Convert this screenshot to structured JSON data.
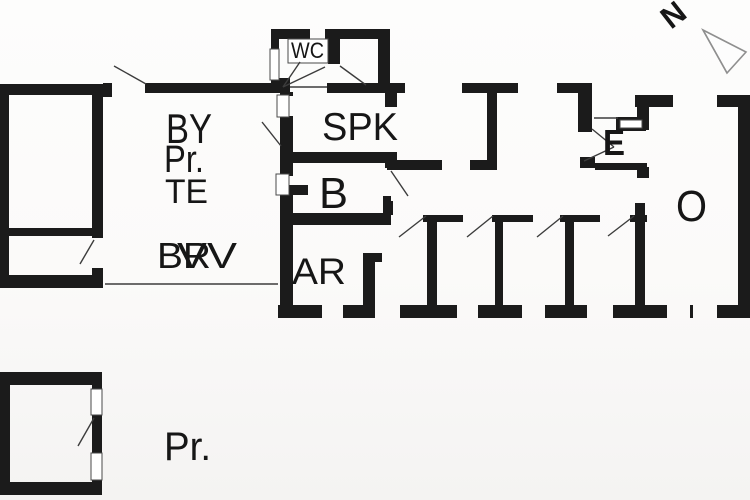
{
  "title": "Holiday house floor plan",
  "canvas": {
    "w": 750,
    "h": 500,
    "bg": "#fbfbfa"
  },
  "colors": {
    "wall": "#1b1b1b",
    "line": "#3c3c3c",
    "window_stroke": "#4a4a4a",
    "label": "#161616",
    "compass": "#8f8f8f"
  },
  "compass": {
    "n_label": "N",
    "translate_x": 671,
    "translate_y": 30,
    "rotate": -38,
    "font_size": 31,
    "body_points": "703,30 746,52 727,73",
    "fold_points": "703,30 717,55 727,73"
  },
  "labels": [
    {
      "name": "room-label-by",
      "text": "BY",
      "x": 166,
      "y": 143,
      "size": 42,
      "len": 46,
      "bold": false
    },
    {
      "name": "room-label-pr-upper",
      "text": "Pr.",
      "x": 164,
      "y": 172,
      "size": 38,
      "len": 40,
      "bold": false
    },
    {
      "name": "room-label-te",
      "text": "TE",
      "x": 165,
      "y": 203,
      "size": 34,
      "len": 43,
      "bold": false
    },
    {
      "name": "room-label-br",
      "text": "BR",
      "x": 157,
      "y": 268,
      "size": 36,
      "len": 54,
      "bold": false
    },
    {
      "name": "room-label-vv",
      "text": "VV",
      "x": 177,
      "y": 268,
      "size": 36,
      "len": 60,
      "bold": false
    },
    {
      "name": "room-label-ar",
      "text": "AR",
      "x": 292,
      "y": 284,
      "size": 37,
      "len": 54,
      "bold": false
    },
    {
      "name": "room-label-spk",
      "text": "SPK",
      "x": 322,
      "y": 140,
      "size": 39,
      "len": 76,
      "bold": false
    },
    {
      "name": "room-label-b",
      "text": "B",
      "x": 319,
      "y": 208,
      "size": 44,
      "len": 29,
      "bold": false
    },
    {
      "name": "room-label-wc",
      "text": "WC",
      "x": 291,
      "y": 58,
      "size": 22,
      "len": 33,
      "bold": false
    },
    {
      "name": "room-label-e",
      "text": "E",
      "x": 603,
      "y": 155,
      "size": 36,
      "len": 22,
      "bold": true
    },
    {
      "name": "room-label-o",
      "text": "O",
      "x": 676,
      "y": 221,
      "size": 44,
      "len": 31,
      "bold": false
    },
    {
      "name": "annex-label-pr",
      "text": "Pr.",
      "x": 164,
      "y": 460,
      "size": 40,
      "len": 47,
      "bold": false
    }
  ],
  "walls": [
    {
      "x": 0,
      "y": 84,
      "w": 103,
      "h": 11
    },
    {
      "x": 0,
      "y": 84,
      "w": 9,
      "h": 204
    },
    {
      "x": 0,
      "y": 275,
      "w": 103,
      "h": 13
    },
    {
      "x": 92,
      "y": 84,
      "w": 11,
      "h": 154
    },
    {
      "x": 92,
      "y": 268,
      "w": 11,
      "h": 20
    },
    {
      "x": 9,
      "y": 228,
      "w": 88,
      "h": 8
    },
    {
      "x": 103,
      "y": 83,
      "w": 9,
      "h": 14
    },
    {
      "x": 145,
      "y": 83,
      "w": 145,
      "h": 10
    },
    {
      "x": 327,
      "y": 83,
      "w": 78,
      "h": 10
    },
    {
      "x": 462,
      "y": 83,
      "w": 56,
      "h": 10
    },
    {
      "x": 557,
      "y": 83,
      "w": 33,
      "h": 10
    },
    {
      "x": 271,
      "y": 78,
      "w": 19,
      "h": 12
    },
    {
      "x": 578,
      "y": 83,
      "w": 14,
      "h": 49
    },
    {
      "x": 580,
      "y": 157,
      "w": 15,
      "h": 11
    },
    {
      "x": 595,
      "y": 163,
      "w": 52,
      "h": 7
    },
    {
      "x": 280,
      "y": 92,
      "w": 13,
      "h": 4
    },
    {
      "x": 280,
      "y": 116,
      "w": 13,
      "h": 60
    },
    {
      "x": 280,
      "y": 194,
      "w": 13,
      "h": 111
    },
    {
      "x": 273,
      "y": 29,
      "w": 37,
      "h": 10
    },
    {
      "x": 325,
      "y": 29,
      "w": 65,
      "h": 10
    },
    {
      "x": 271,
      "y": 29,
      "w": 8,
      "h": 20
    },
    {
      "x": 378,
      "y": 29,
      "w": 12,
      "h": 63
    },
    {
      "x": 328,
      "y": 38,
      "w": 12,
      "h": 26
    },
    {
      "x": 385,
      "y": 83,
      "w": 12,
      "h": 24
    },
    {
      "x": 283,
      "y": 152,
      "w": 104,
      "h": 11
    },
    {
      "x": 385,
      "y": 152,
      "w": 12,
      "h": 16
    },
    {
      "x": 283,
      "y": 213,
      "w": 108,
      "h": 12
    },
    {
      "x": 383,
      "y": 196,
      "w": 8,
      "h": 18
    },
    {
      "x": 383,
      "y": 201,
      "w": 10,
      "h": 14
    },
    {
      "x": 288,
      "y": 185,
      "w": 20,
      "h": 10
    },
    {
      "x": 387,
      "y": 160,
      "w": 55,
      "h": 10
    },
    {
      "x": 470,
      "y": 160,
      "w": 27,
      "h": 10
    },
    {
      "x": 487,
      "y": 92,
      "w": 10,
      "h": 68
    },
    {
      "x": 423,
      "y": 215,
      "w": 40,
      "h": 7
    },
    {
      "x": 492,
      "y": 215,
      "w": 41,
      "h": 7
    },
    {
      "x": 560,
      "y": 215,
      "w": 40,
      "h": 7
    },
    {
      "x": 630,
      "y": 215,
      "w": 17,
      "h": 7
    },
    {
      "x": 427,
      "y": 215,
      "w": 10,
      "h": 90
    },
    {
      "x": 495,
      "y": 215,
      "w": 8,
      "h": 90
    },
    {
      "x": 565,
      "y": 215,
      "w": 9,
      "h": 90
    },
    {
      "x": 363,
      "y": 253,
      "w": 12,
      "h": 52
    },
    {
      "x": 363,
      "y": 253,
      "w": 19,
      "h": 9
    },
    {
      "x": 278,
      "y": 305,
      "w": 44,
      "h": 13
    },
    {
      "x": 343,
      "y": 305,
      "w": 32,
      "h": 13
    },
    {
      "x": 400,
      "y": 305,
      "w": 57,
      "h": 13
    },
    {
      "x": 478,
      "y": 305,
      "w": 44,
      "h": 13
    },
    {
      "x": 545,
      "y": 305,
      "w": 42,
      "h": 13
    },
    {
      "x": 613,
      "y": 305,
      "w": 54,
      "h": 13
    },
    {
      "x": 690,
      "y": 305,
      "w": 3,
      "h": 13
    },
    {
      "x": 717,
      "y": 305,
      "w": 33,
      "h": 13
    },
    {
      "x": 635,
      "y": 95,
      "w": 38,
      "h": 12
    },
    {
      "x": 717,
      "y": 95,
      "w": 33,
      "h": 12
    },
    {
      "x": 738,
      "y": 95,
      "w": 12,
      "h": 223
    },
    {
      "x": 637,
      "y": 95,
      "w": 12,
      "h": 35
    },
    {
      "x": 637,
      "y": 167,
      "w": 12,
      "h": 11
    },
    {
      "x": 635,
      "y": 203,
      "w": 10,
      "h": 102
    },
    {
      "x": 616,
      "y": 117,
      "w": 30,
      "h": 14
    },
    {
      "x": 0,
      "y": 372,
      "w": 102,
      "h": 13
    },
    {
      "x": 0,
      "y": 372,
      "w": 10,
      "h": 123
    },
    {
      "x": 0,
      "y": 482,
      "w": 102,
      "h": 13
    },
    {
      "x": 92,
      "y": 372,
      "w": 10,
      "h": 20
    },
    {
      "x": 92,
      "y": 414,
      "w": 10,
      "h": 42
    },
    {
      "x": 92,
      "y": 478,
      "w": 10,
      "h": 17
    }
  ],
  "openings": [
    {
      "x": 277,
      "y": 95,
      "w": 12,
      "h": 22
    },
    {
      "x": 276,
      "y": 174,
      "w": 13,
      "h": 21
    },
    {
      "x": 270,
      "y": 49,
      "w": 9,
      "h": 31
    },
    {
      "x": 620,
      "y": 120,
      "w": 22,
      "h": 8
    },
    {
      "x": 91,
      "y": 389,
      "w": 11,
      "h": 26
    },
    {
      "x": 91,
      "y": 453,
      "w": 11,
      "h": 27
    }
  ],
  "thin_boxes": [
    {
      "x": 288,
      "y": 39,
      "w": 40,
      "h": 24
    }
  ],
  "swing_lines": [
    {
      "x1": 114,
      "y1": 66,
      "x2": 146,
      "y2": 84
    },
    {
      "x1": 262,
      "y1": 122,
      "x2": 281,
      "y2": 146
    },
    {
      "x1": 283,
      "y1": 87,
      "x2": 300,
      "y2": 62
    },
    {
      "x1": 283,
      "y1": 87,
      "x2": 325,
      "y2": 67
    },
    {
      "x1": 340,
      "y1": 66,
      "x2": 366,
      "y2": 85
    },
    {
      "x1": 391,
      "y1": 171,
      "x2": 408,
      "y2": 196
    },
    {
      "x1": 399,
      "y1": 237,
      "x2": 426,
      "y2": 216
    },
    {
      "x1": 467,
      "y1": 237,
      "x2": 493,
      "y2": 216
    },
    {
      "x1": 537,
      "y1": 237,
      "x2": 563,
      "y2": 216
    },
    {
      "x1": 608,
      "y1": 236,
      "x2": 634,
      "y2": 216
    },
    {
      "x1": 592,
      "y1": 129,
      "x2": 614,
      "y2": 147
    },
    {
      "x1": 584,
      "y1": 161,
      "x2": 614,
      "y2": 147
    },
    {
      "x1": 80,
      "y1": 264,
      "x2": 94,
      "y2": 240
    },
    {
      "x1": 78,
      "y1": 446,
      "x2": 94,
      "y2": 418
    },
    {
      "x1": 105,
      "y1": 284,
      "x2": 278,
      "y2": 284
    },
    {
      "x1": 594,
      "y1": 118,
      "x2": 618,
      "y2": 118
    },
    {
      "x1": 290,
      "y1": 87,
      "x2": 327,
      "y2": 87
    }
  ]
}
